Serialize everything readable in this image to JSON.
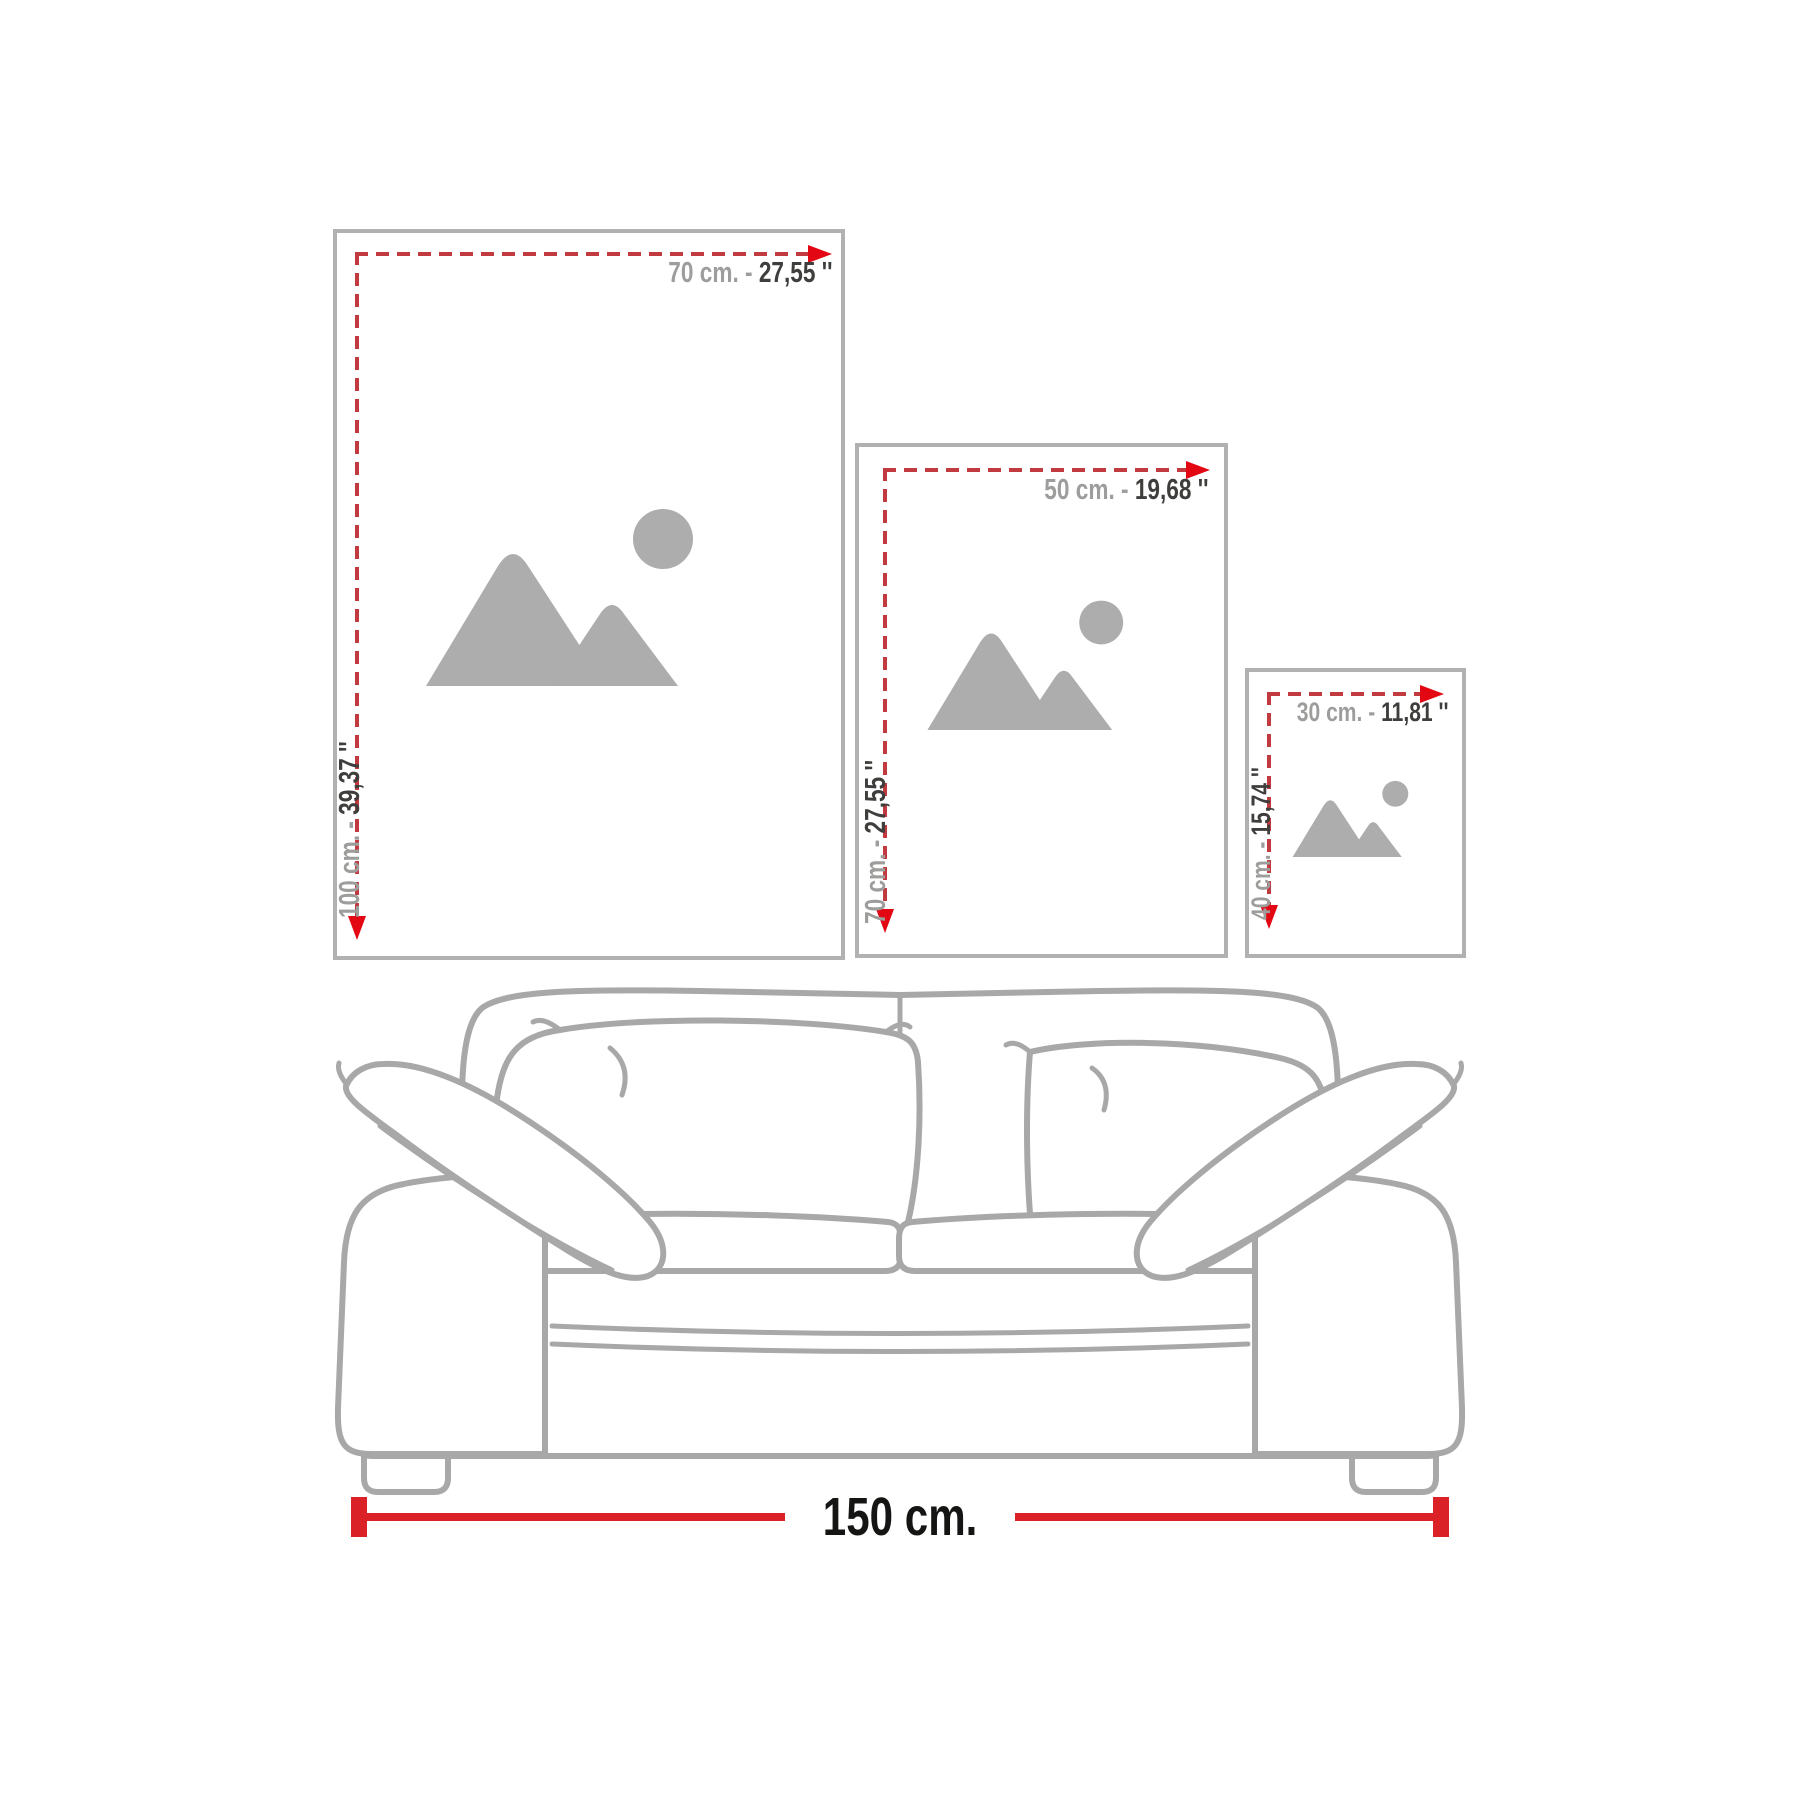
{
  "frames": [
    {
      "id": "frame-70x100",
      "width_gray": "70 cm. -",
      "width_dark": "27,55 ''",
      "height_gray": "100 cm. -",
      "height_dark": "39,37 ''"
    },
    {
      "id": "frame-50x70",
      "width_gray": "50 cm. -",
      "width_dark": "19,68 ''",
      "height_gray": "70 cm. -",
      "height_dark": "27,55 ''"
    },
    {
      "id": "frame-30x40",
      "width_gray": "30 cm. -",
      "width_dark": "11,81 ''",
      "height_gray": "40 cm. -",
      "height_dark": "15,74 ''"
    }
  ],
  "sofa": {
    "width_label": "150 cm."
  },
  "icons": {
    "placeholder": "image-placeholder-icon"
  },
  "colors": {
    "dash_red": "#c13a40",
    "arrow_red": "#e30613",
    "measure_red": "#da2128",
    "frame_border": "#b1b1b1",
    "icon_gray": "#adadad",
    "label_gray": "#9d9d9c",
    "label_dark": "#3f3e3c",
    "sofa_line": "#a8a8a8",
    "measure_text": "#151513"
  }
}
